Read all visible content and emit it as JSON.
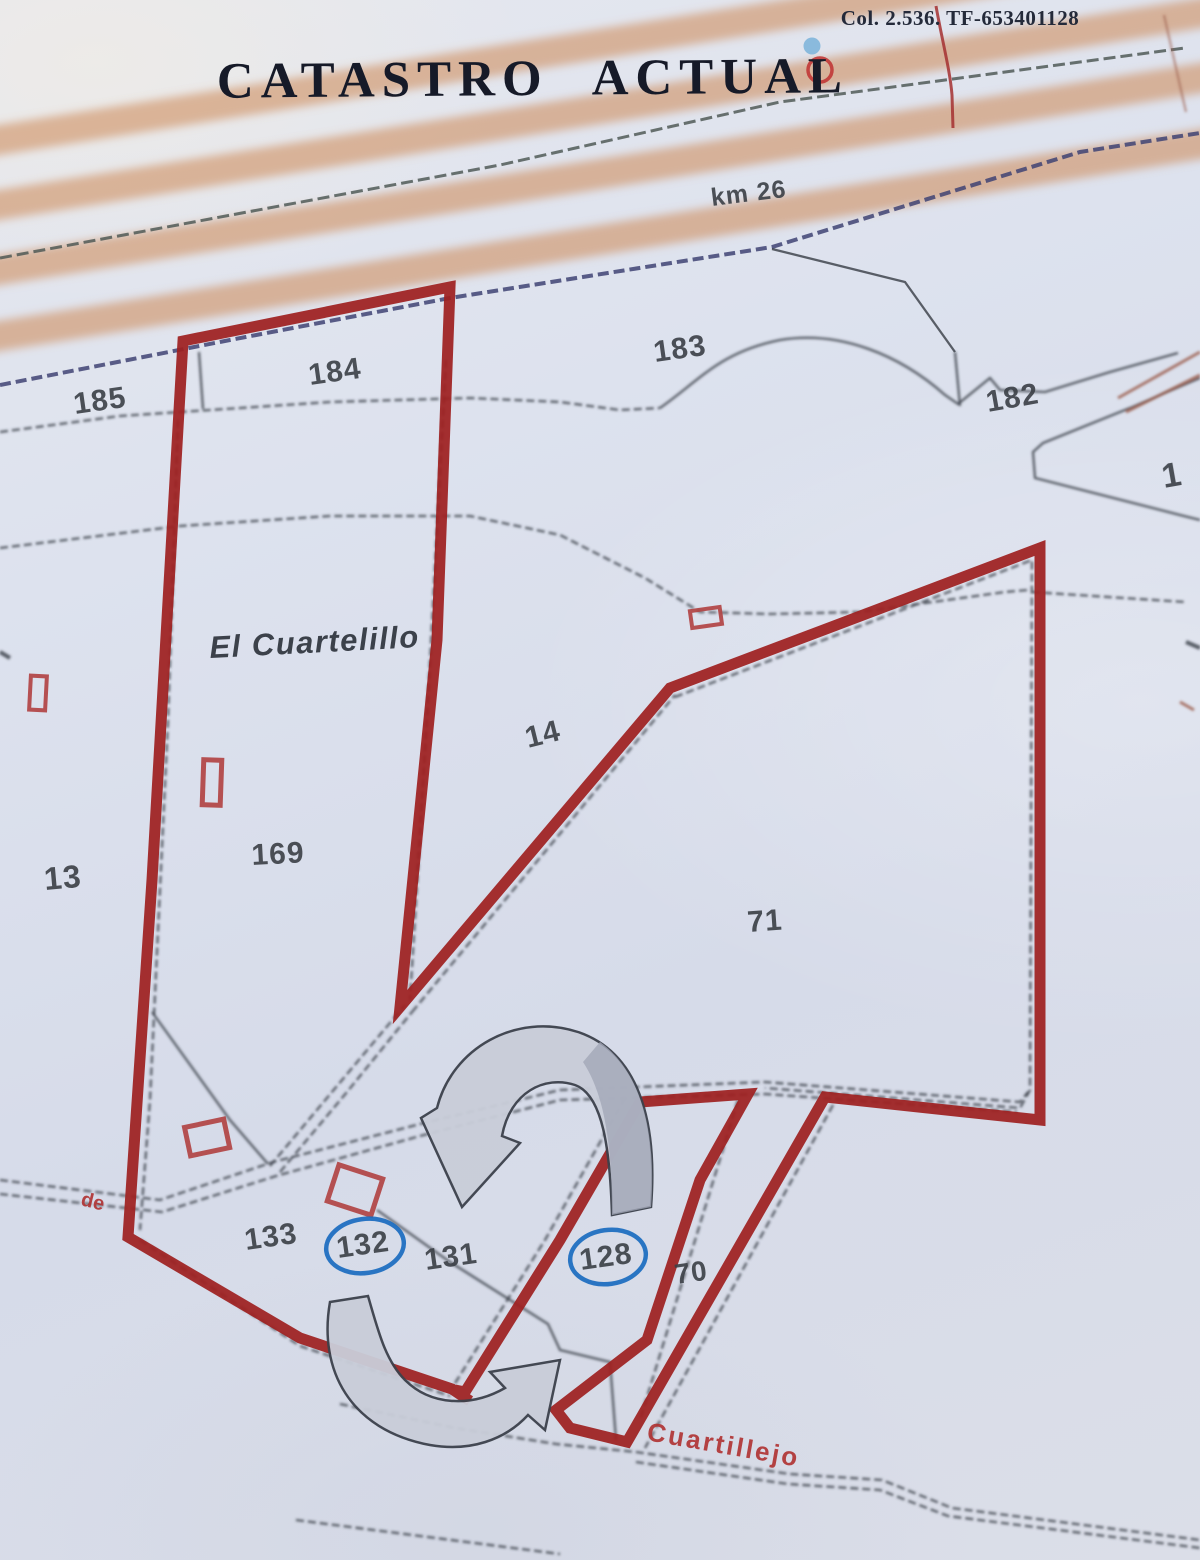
{
  "document": {
    "title": "CATASTRO ACTUAL",
    "reference": "Col. 2.536. TF-653401128"
  },
  "map": {
    "region_label": "El Cuartelillo",
    "road_km_label": "km 26",
    "path_label_left": "de",
    "path_label_bottom": "Cuartillejo",
    "highlighted_parcels": [
      "132",
      "128"
    ],
    "parcel_labels": [
      {
        "text": "185",
        "x": 75,
        "y": 414,
        "rot": -8,
        "size": 30
      },
      {
        "text": "184",
        "x": 310,
        "y": 385,
        "rot": -8,
        "size": 30
      },
      {
        "text": "183",
        "x": 655,
        "y": 362,
        "rot": -8,
        "size": 30
      },
      {
        "text": "182",
        "x": 988,
        "y": 412,
        "rot": -10,
        "size": 30
      },
      {
        "text": "1",
        "x": 1164,
        "y": 488,
        "rot": -10,
        "size": 34
      },
      {
        "text": "13",
        "x": 45,
        "y": 890,
        "rot": -5,
        "size": 32
      },
      {
        "text": "169",
        "x": 252,
        "y": 865,
        "rot": -3,
        "size": 30
      },
      {
        "text": "14",
        "x": 528,
        "y": 748,
        "rot": -14,
        "size": 30
      },
      {
        "text": "71",
        "x": 748,
        "y": 932,
        "rot": -4,
        "size": 30
      },
      {
        "text": "133",
        "x": 246,
        "y": 1250,
        "rot": -8,
        "size": 30
      },
      {
        "text": "132",
        "x": 338,
        "y": 1258,
        "rot": -8,
        "size": 30,
        "circled": true,
        "cx": 365,
        "cy": 1246,
        "rx": 39,
        "ry": 27
      },
      {
        "text": "131",
        "x": 426,
        "y": 1270,
        "rot": -8,
        "size": 30
      },
      {
        "text": "128",
        "x": 581,
        "y": 1270,
        "rot": -8,
        "size": 30,
        "circled": true,
        "cx": 608,
        "cy": 1257,
        "rx": 38,
        "ry": 27
      },
      {
        "text": "70",
        "x": 676,
        "y": 1284,
        "rot": -8,
        "size": 28
      }
    ],
    "colors": {
      "paper": "#dde2ee",
      "boundary_red": "#9e2020",
      "parcel_line": "#3b4048",
      "navy_line": "#3f4373",
      "road_orange": "#cf8f60",
      "highlight_blue": "#1a6bbf",
      "building_red": "#b04040",
      "building_fill": "#aacbe4",
      "arrow_fill": "#c9cdd9",
      "arrow_dark": "#a3a8b8",
      "label_red": "#b03030",
      "text_dark": "#3a3f45",
      "title_color": "#161a28"
    }
  }
}
